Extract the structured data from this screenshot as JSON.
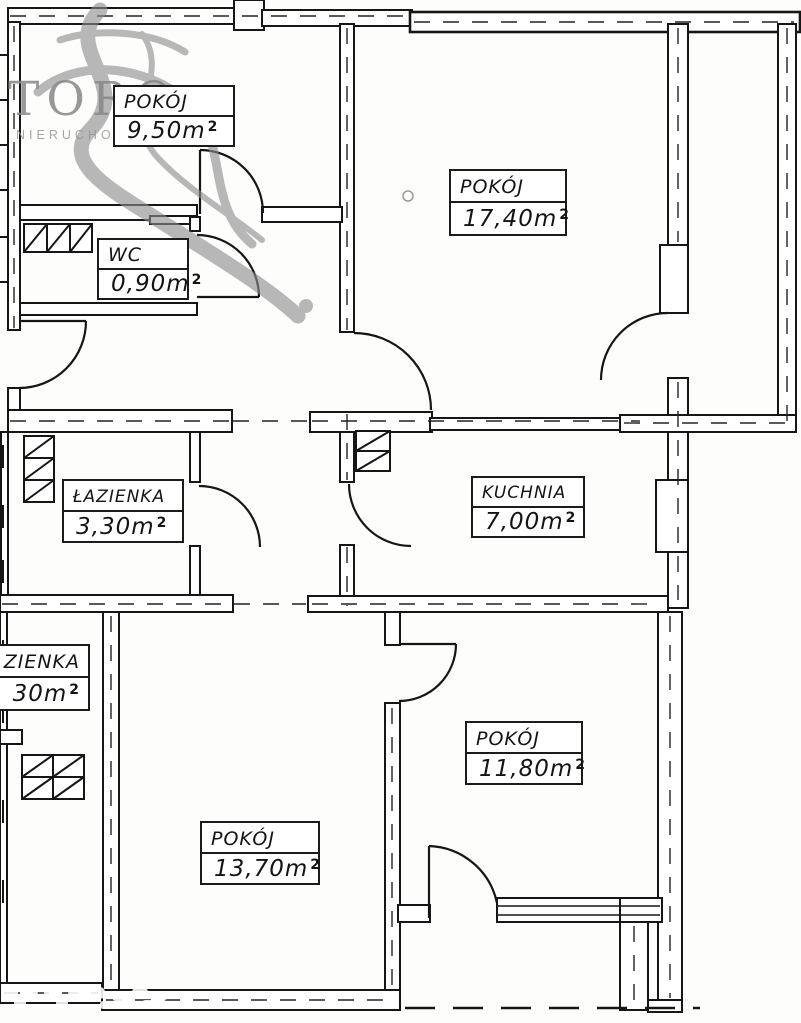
{
  "document": {
    "kind": "apartment floor plan (scan)"
  },
  "agency_watermark": {
    "brand": "TORO",
    "subtitle": "NIERUCHOMOŚCI"
  },
  "rooms": [
    {
      "id": "pokoj-950",
      "name": "POKÓJ",
      "area": "9,50m",
      "sup": "2"
    },
    {
      "id": "wc-090",
      "name": "WC",
      "area": "0,90m",
      "sup": "2"
    },
    {
      "id": "pokoj-1740",
      "name": "POKÓJ",
      "area": "17,40m",
      "sup": "2"
    },
    {
      "id": "lazienka-330",
      "name": "ŁAZIENKA",
      "area": "3,30m",
      "sup": "2"
    },
    {
      "id": "kuchnia-700",
      "name": "KUCHNIA",
      "area": "7,00m",
      "sup": "2"
    },
    {
      "id": "lazienka-cut",
      "name": "ZIENKA",
      "area": "30m",
      "sup": "2"
    },
    {
      "id": "pokoj-1180",
      "name": "POKÓJ",
      "area": "11,80m",
      "sup": "2"
    },
    {
      "id": "pokoj-1370",
      "name": "POKÓJ",
      "area": "13,70m",
      "sup": "2"
    }
  ],
  "colors": {
    "ink": "#161616",
    "paper": "#ffffff",
    "logo_gray": "#8a8a8a"
  }
}
